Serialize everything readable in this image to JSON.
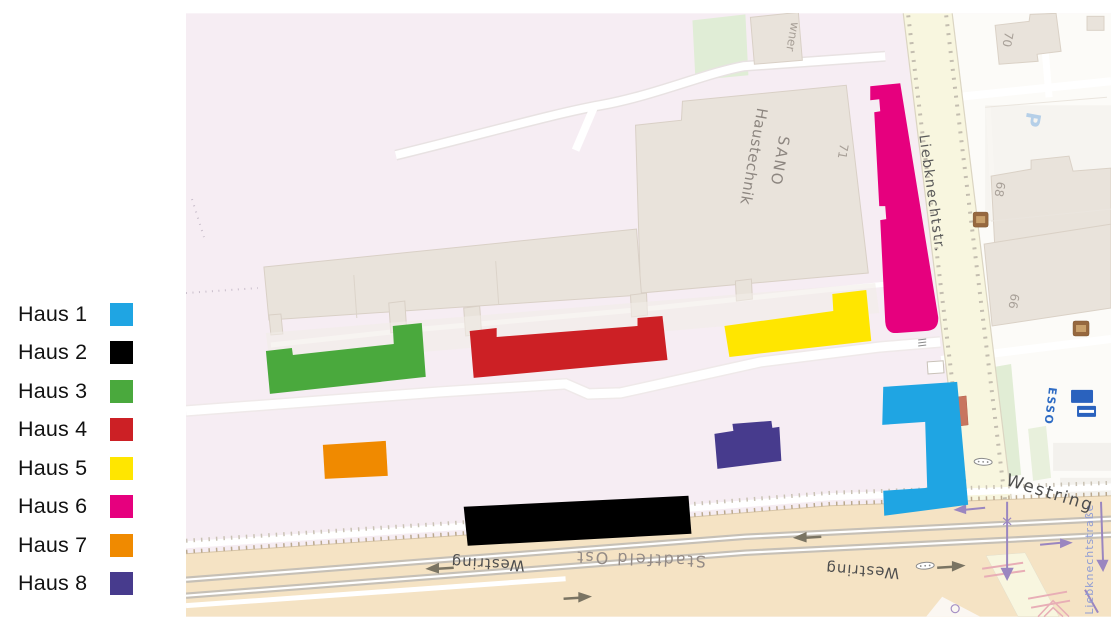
{
  "houses": [
    {
      "id": "haus-1",
      "label": "Haus 1",
      "color": "#1FA5E3"
    },
    {
      "id": "haus-2",
      "label": "Haus 2",
      "color": "#000000"
    },
    {
      "id": "haus-3",
      "label": "Haus 3",
      "color": "#4AA93D"
    },
    {
      "id": "haus-4",
      "label": "Haus 4",
      "color": "#CC2025"
    },
    {
      "id": "haus-5",
      "label": "Haus 5",
      "color": "#FFE600"
    },
    {
      "id": "haus-6",
      "label": "Haus 6",
      "color": "#E6007E"
    },
    {
      "id": "haus-7",
      "label": "Haus 7",
      "color": "#F08A00"
    },
    {
      "id": "haus-8",
      "label": "Haus 8",
      "color": "#473B8D"
    }
  ],
  "map": {
    "streets": {
      "liebknechtstr_abbr": "Liebknechtstr.",
      "liebknechtstrasse_full": "Liebknechtstraße",
      "westring_upside_down_left": "Westring",
      "westring_upside_down_right": "Westring",
      "westring_corner": "Westring",
      "partial_name_top": "wner"
    },
    "district_label": "Stadtfeld Ost",
    "building_labels": {
      "sano_line1": "SANO",
      "sano_line2": "Haustechnik",
      "no_71": "71",
      "no_70": "70",
      "no_68": "68",
      "no_66": "66"
    },
    "poi": {
      "parking_glyph": "P",
      "fuel_station": "ESSO"
    },
    "palette": {
      "land_pink": "#F6EDF3",
      "urban_white": "#FCFBF8",
      "building_fill": "#E9E3DB",
      "building_stroke": "#D9D0C6",
      "minor_street_yellow": "#F8F6DF",
      "major_road_tan": "#F5E3C4",
      "grass_green": "#E1EDD5",
      "tram_gray": "#C6C0B6",
      "route_purple": "#9A86C0",
      "crossing_pink": "#E8AEB6",
      "label_gray": "#5A5A5A"
    }
  }
}
